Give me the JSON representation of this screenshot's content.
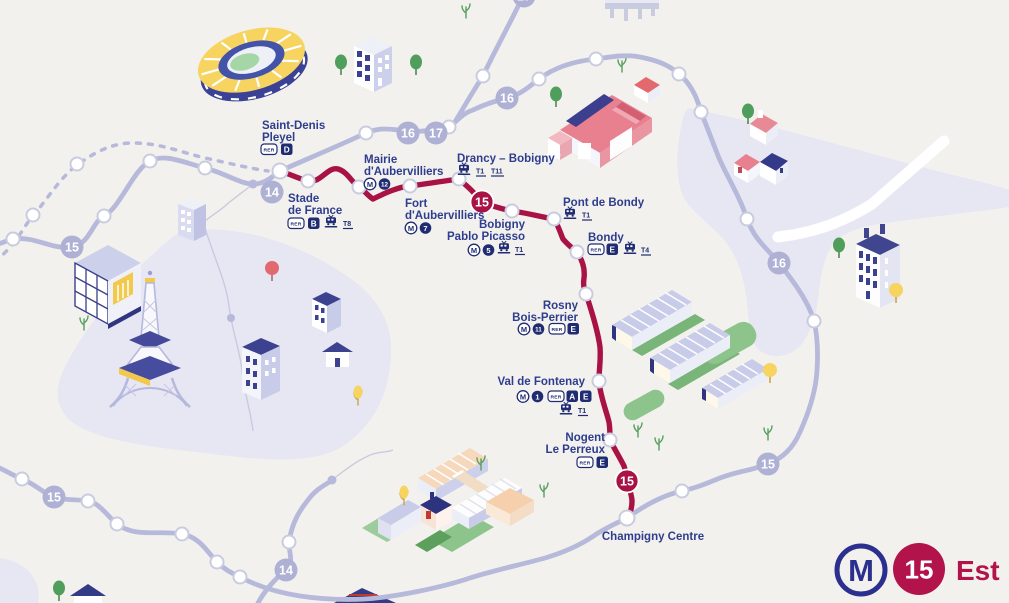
{
  "legend": {
    "metro_symbol": "M",
    "line_number": "15",
    "line_name": "Est"
  },
  "line_badges": {
    "fourteen": "14",
    "fifteen": "15",
    "sixteen": "16",
    "seventeen": "17"
  },
  "stations": [
    {
      "id": "saint-denis-pleyel",
      "name": [
        "Saint-Denis",
        "Pleyel"
      ],
      "rer_label": "RER",
      "rer_lines": [
        "D"
      ]
    },
    {
      "id": "stade-de-france",
      "name": [
        "Stade",
        "de France"
      ],
      "rer_label": "RER",
      "rer_lines": [
        "B"
      ],
      "tram_lines": [
        "T8"
      ]
    },
    {
      "id": "mairie-daubervilliers",
      "name": [
        "Mairie",
        "d'Aubervilliers"
      ],
      "metro_label": "M",
      "metro_lines": [
        "12"
      ]
    },
    {
      "id": "fort-daubervilliers",
      "name": [
        "Fort",
        "d'Aubervilliers"
      ],
      "metro_label": "M",
      "metro_lines": [
        "7"
      ]
    },
    {
      "id": "drancy-bobigny",
      "name": [
        "Drancy – Bobigny"
      ],
      "tram_lines": [
        "T1",
        "T11"
      ]
    },
    {
      "id": "bobigny-pablo-picasso",
      "name": [
        "Bobigny",
        "Pablo Picasso"
      ],
      "metro_label": "M",
      "metro_lines": [
        "5"
      ],
      "tram_lines": [
        "T1"
      ]
    },
    {
      "id": "pont-de-bondy",
      "name": [
        "Pont de Bondy"
      ],
      "tram_lines": [
        "T1"
      ]
    },
    {
      "id": "bondy",
      "name": [
        "Bondy"
      ],
      "rer_label": "RER",
      "rer_lines": [
        "E"
      ],
      "tram_lines": [
        "T4"
      ]
    },
    {
      "id": "rosny-bois-perrier",
      "name": [
        "Rosny",
        "Bois-Perrier"
      ],
      "metro_label": "M",
      "metro_lines": [
        "11"
      ],
      "rer_label": "RER",
      "rer_lines": [
        "E"
      ]
    },
    {
      "id": "val-de-fontenay",
      "name": [
        "Val de Fontenay"
      ],
      "metro_label": "M",
      "metro_lines": [
        "1"
      ],
      "rer_label": "RER",
      "rer_lines": [
        "A",
        "E"
      ],
      "tram_lines": [
        "T1"
      ]
    },
    {
      "id": "nogent-le-perreux",
      "name": [
        "Nogent",
        "Le Perreux"
      ],
      "rer_label": "RER",
      "rer_lines": [
        "E"
      ]
    },
    {
      "id": "champigny-centre",
      "name": [
        "Champigny Centre"
      ]
    }
  ],
  "colors": {
    "background": "#f3f1ee",
    "city_zone": "#e7e6f3",
    "line_15_red": "#a81245",
    "network_gray": "#b6b9d9",
    "badge_gray": "#aeb1d4",
    "label_blue": "#2e3d8d",
    "badge_navy": "#202c72",
    "legend_red": "#b3134b",
    "legend_blue": "#2b2f8e"
  }
}
